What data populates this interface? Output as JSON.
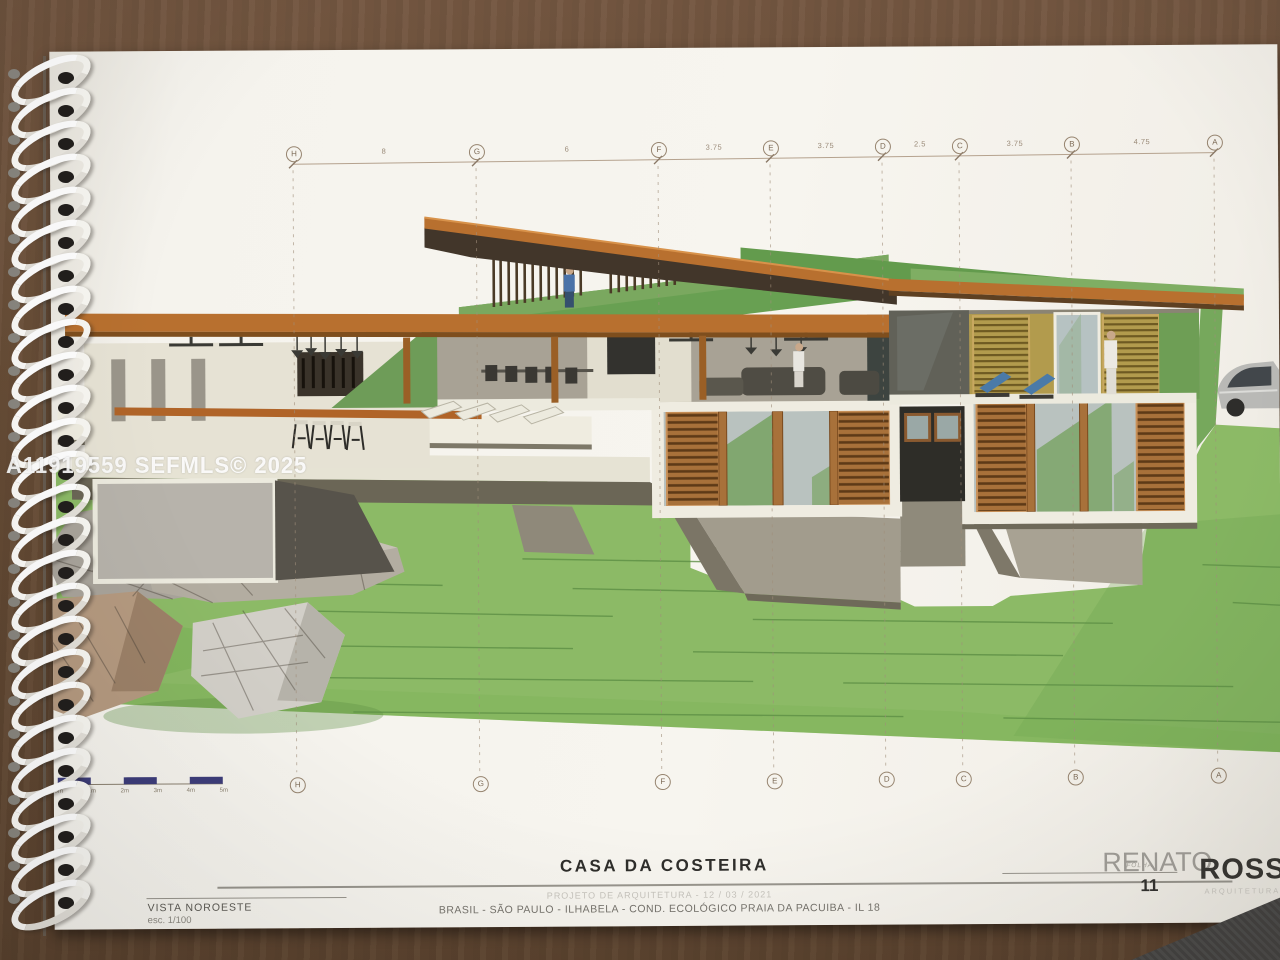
{
  "watermark": "A11919559 SEFMLS© 2025",
  "sheet": {
    "title": "CASA DA COSTEIRA",
    "project_line": "PROJETO DE ARQUITETURA - 12 / 03 / 2021",
    "location_line": "BRASIL - SÃO PAULO - ILHABELA - COND. ECOLÓGICO PRAIA DA PACUIBA - IL 18",
    "view_label": "VISTA NOROESTE",
    "scale_label": "esc. 1/100",
    "sheet_word": "FOLHA",
    "sheet_number": "11"
  },
  "logo": {
    "first": "RENATO",
    "second": "ROSSI",
    "tagline": "ARQUITETURA"
  },
  "grid": {
    "letters": [
      "H",
      "G",
      "F",
      "E",
      "D",
      "C",
      "B",
      "A"
    ],
    "dimensions": [
      "8",
      "6",
      "3.75",
      "3.75",
      "2.5",
      "3.75",
      "4.75"
    ]
  },
  "scalebar": {
    "labels": [
      "0m",
      "1m",
      "2m",
      "3m",
      "4m",
      "5m"
    ]
  },
  "drawing": {
    "subject": "Hillside house 3D elevation, northwest view",
    "colors": {
      "accent_orange": "#B8702F",
      "roof_green": "#639B4D",
      "lawn_green": "#8CBA66",
      "louver_wood": "#A8713A",
      "mustard_wall": "#B29B4D",
      "scalebar_blue": "#3D3D7A"
    }
  }
}
